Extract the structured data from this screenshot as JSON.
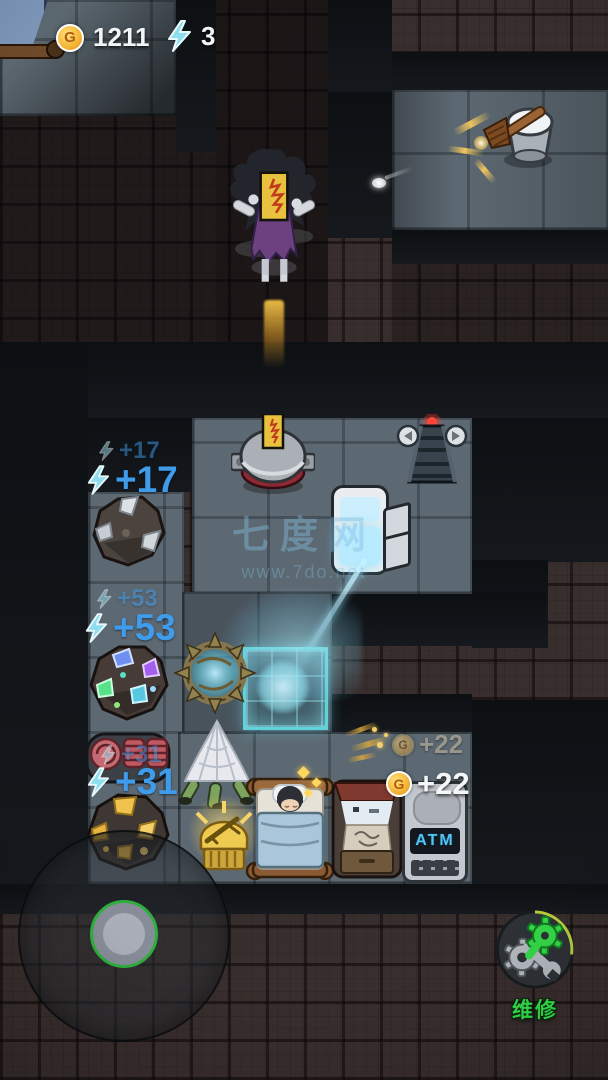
{
  "hud": {
    "coin_icon": "G",
    "coins": "1211",
    "energy": "3"
  },
  "gains": {
    "energy17_old": "+17",
    "energy17_new": "+17",
    "energy53_old": "+53",
    "energy53_new": "+53",
    "energy31_old": "+31",
    "energy31_new": "+31",
    "coin22_old": "+22",
    "coin22_new": "+22"
  },
  "machines": {
    "atm_label": "ATM"
  },
  "controls": {
    "repair_label": "维修"
  },
  "watermark": {
    "title": "七度网",
    "url": "www.7do.net"
  },
  "colors": {
    "gain_blue": "#3f9ceb",
    "coin_gold": "#f5b73a",
    "energy_cyan": "#8fdef0",
    "repair_green": "#35df4a",
    "beam_cyan": "#8ae4f5",
    "room_floor": "#5d6972",
    "outer_floor": "#382e2d"
  }
}
